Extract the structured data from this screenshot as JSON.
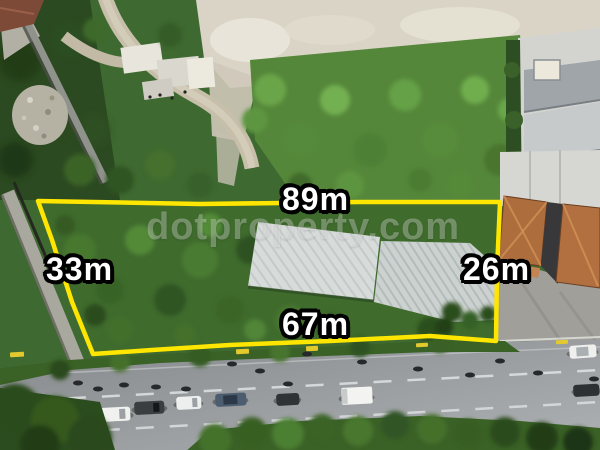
{
  "photo": {
    "plot_boundary": {
      "color": "#ffe600",
      "labels": {
        "top": "89m",
        "left": "33m",
        "right": "26m",
        "bottom": "67m"
      }
    },
    "label_style": {
      "text_color": "#ffffff",
      "outline_color": "#000000"
    },
    "watermark": {
      "text": "dotproperty.com"
    }
  }
}
